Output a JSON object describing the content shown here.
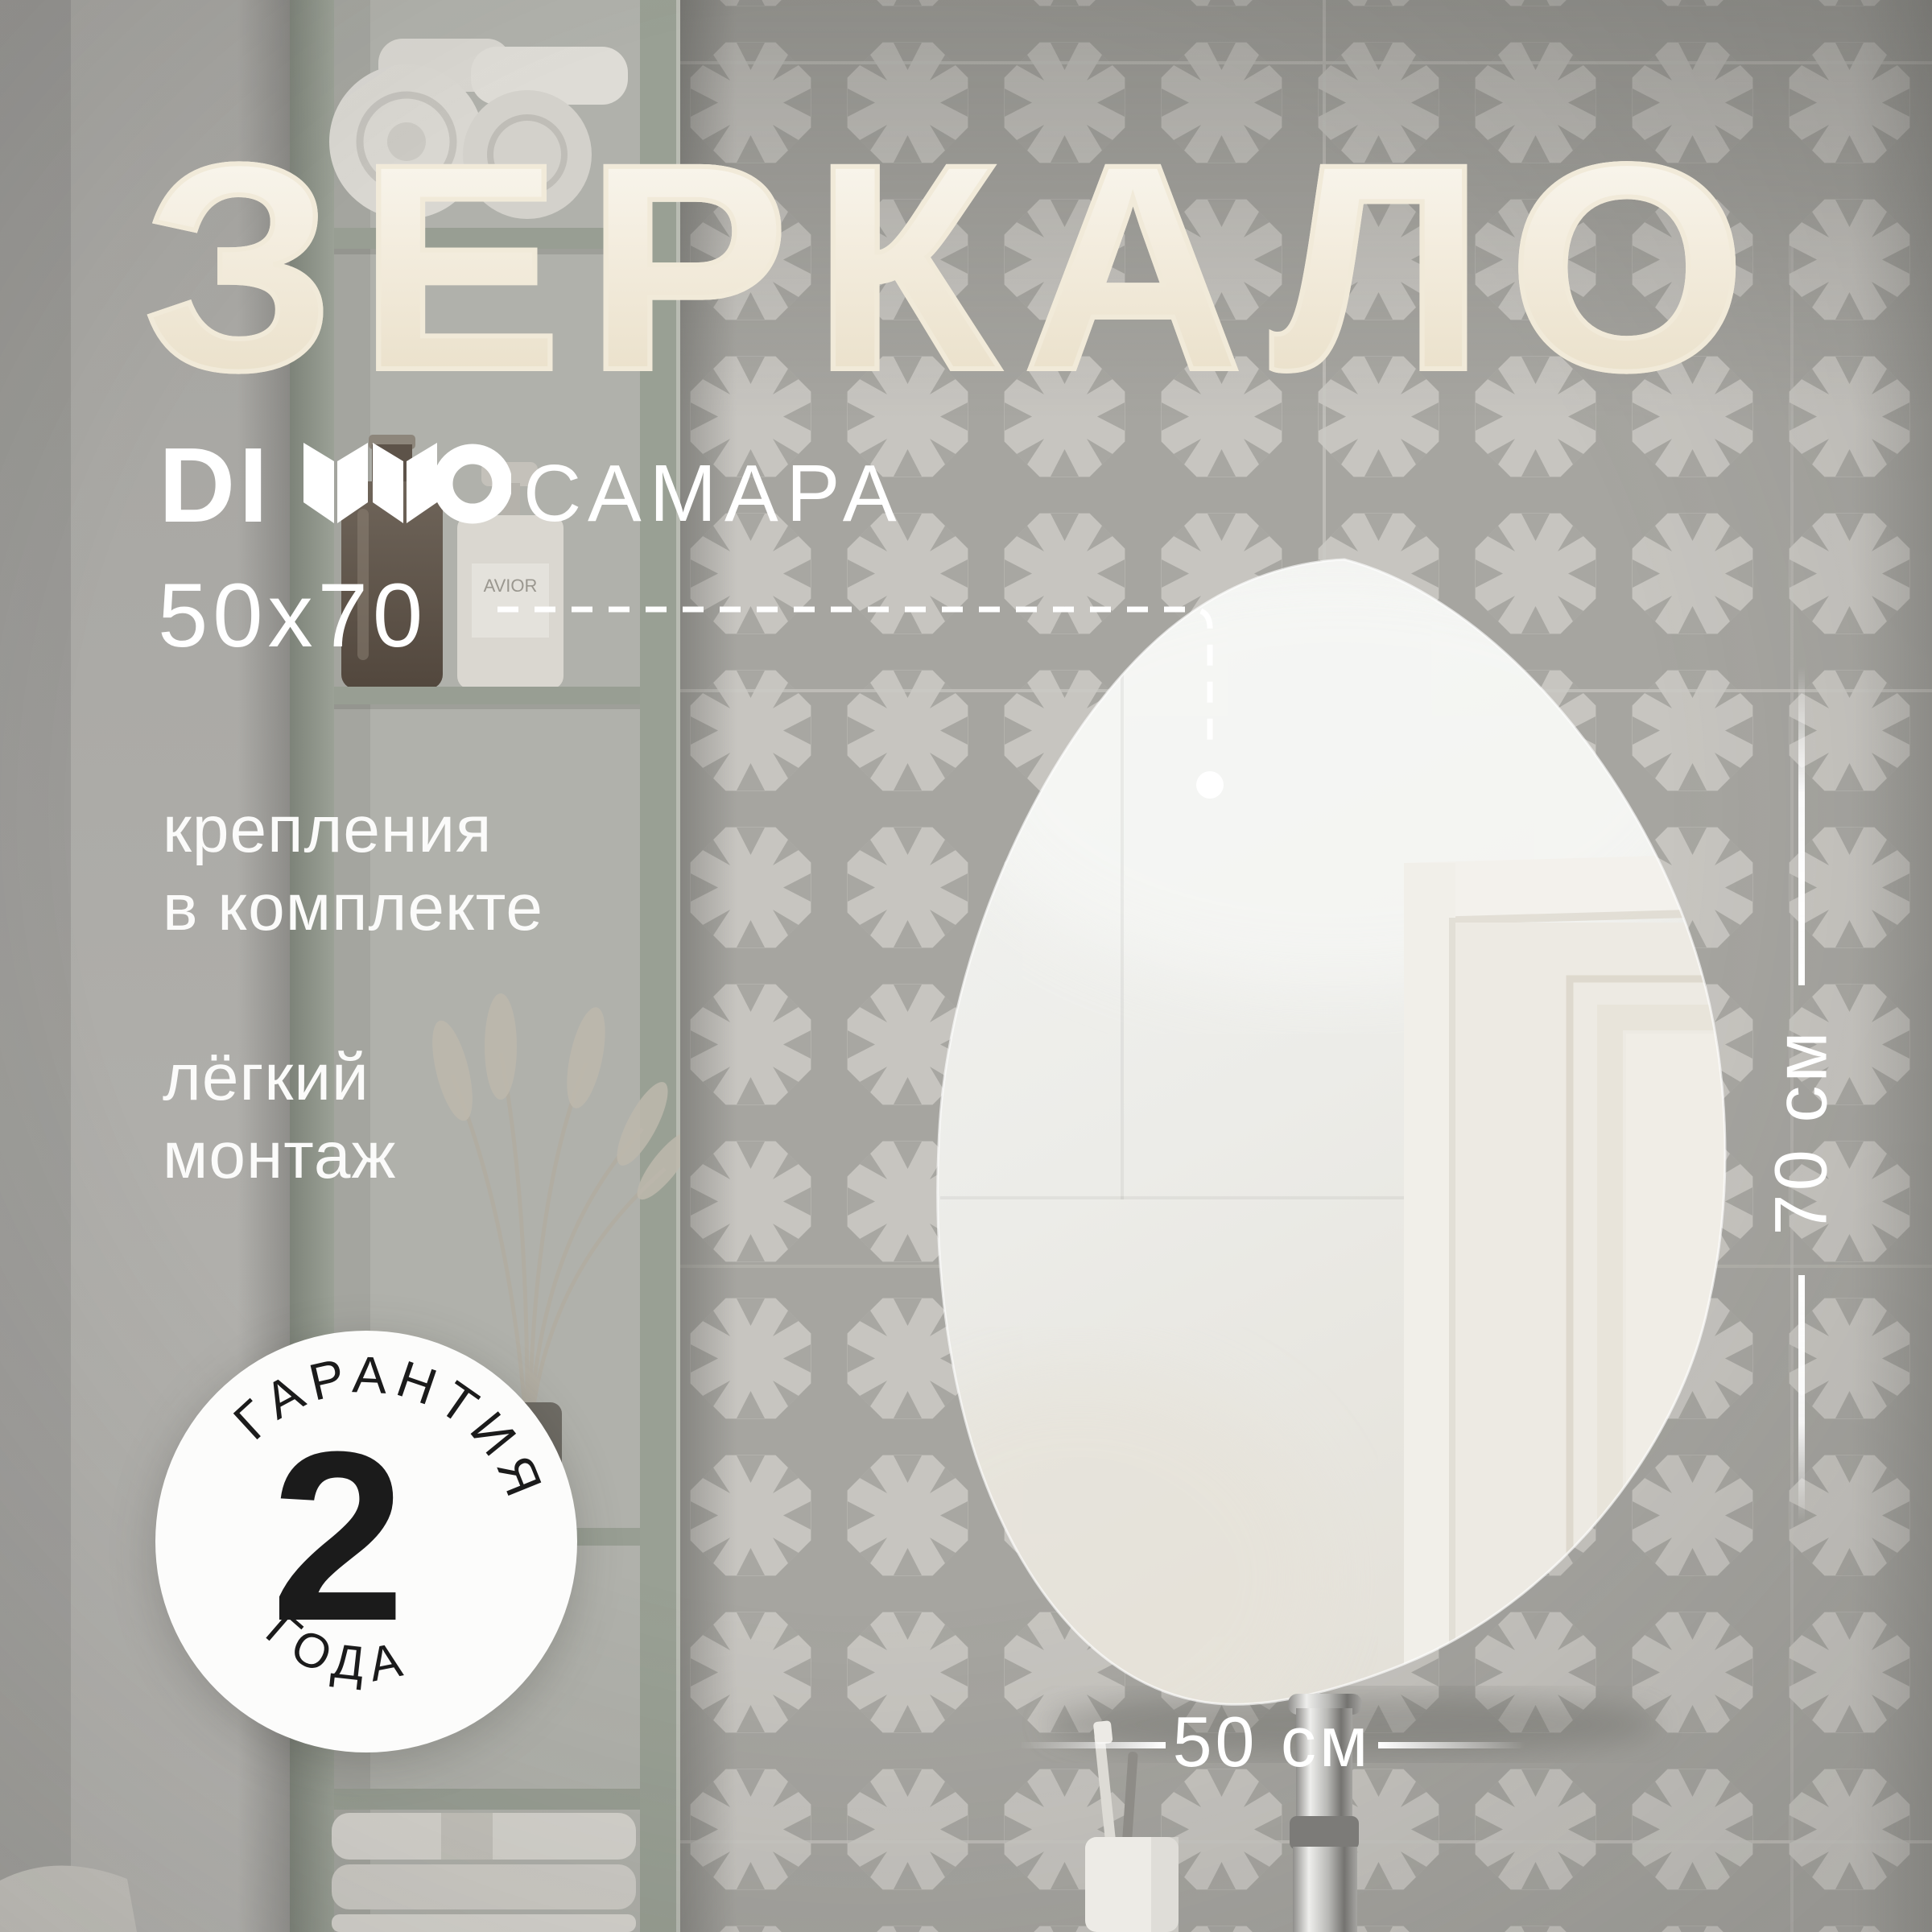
{
  "title": "ЗЕРКАЛО",
  "brand": {
    "logo_di": "DI",
    "logo_o": "O",
    "name_full": "DIVVO"
  },
  "model": "САМАРА",
  "size": "50x70",
  "features": [
    {
      "line1": "крепления",
      "line2": "в комплекте"
    },
    {
      "line1": "лёгкий",
      "line2": "монтаж"
    }
  ],
  "badge": {
    "arc_top": "ГАРАНТИЯ",
    "number": "2",
    "arc_bottom": "ГОДА"
  },
  "dimensions": {
    "height": "70 см",
    "width": "50 см"
  },
  "photo": {
    "bottle_label": "AVIOR"
  },
  "colors": {
    "title_top": "#f9f6ee",
    "title_bottom": "#e9dfc8",
    "text": "#ffffff",
    "badge_bg": "#fcfcfb",
    "badge_text": "#1b1b1b"
  }
}
